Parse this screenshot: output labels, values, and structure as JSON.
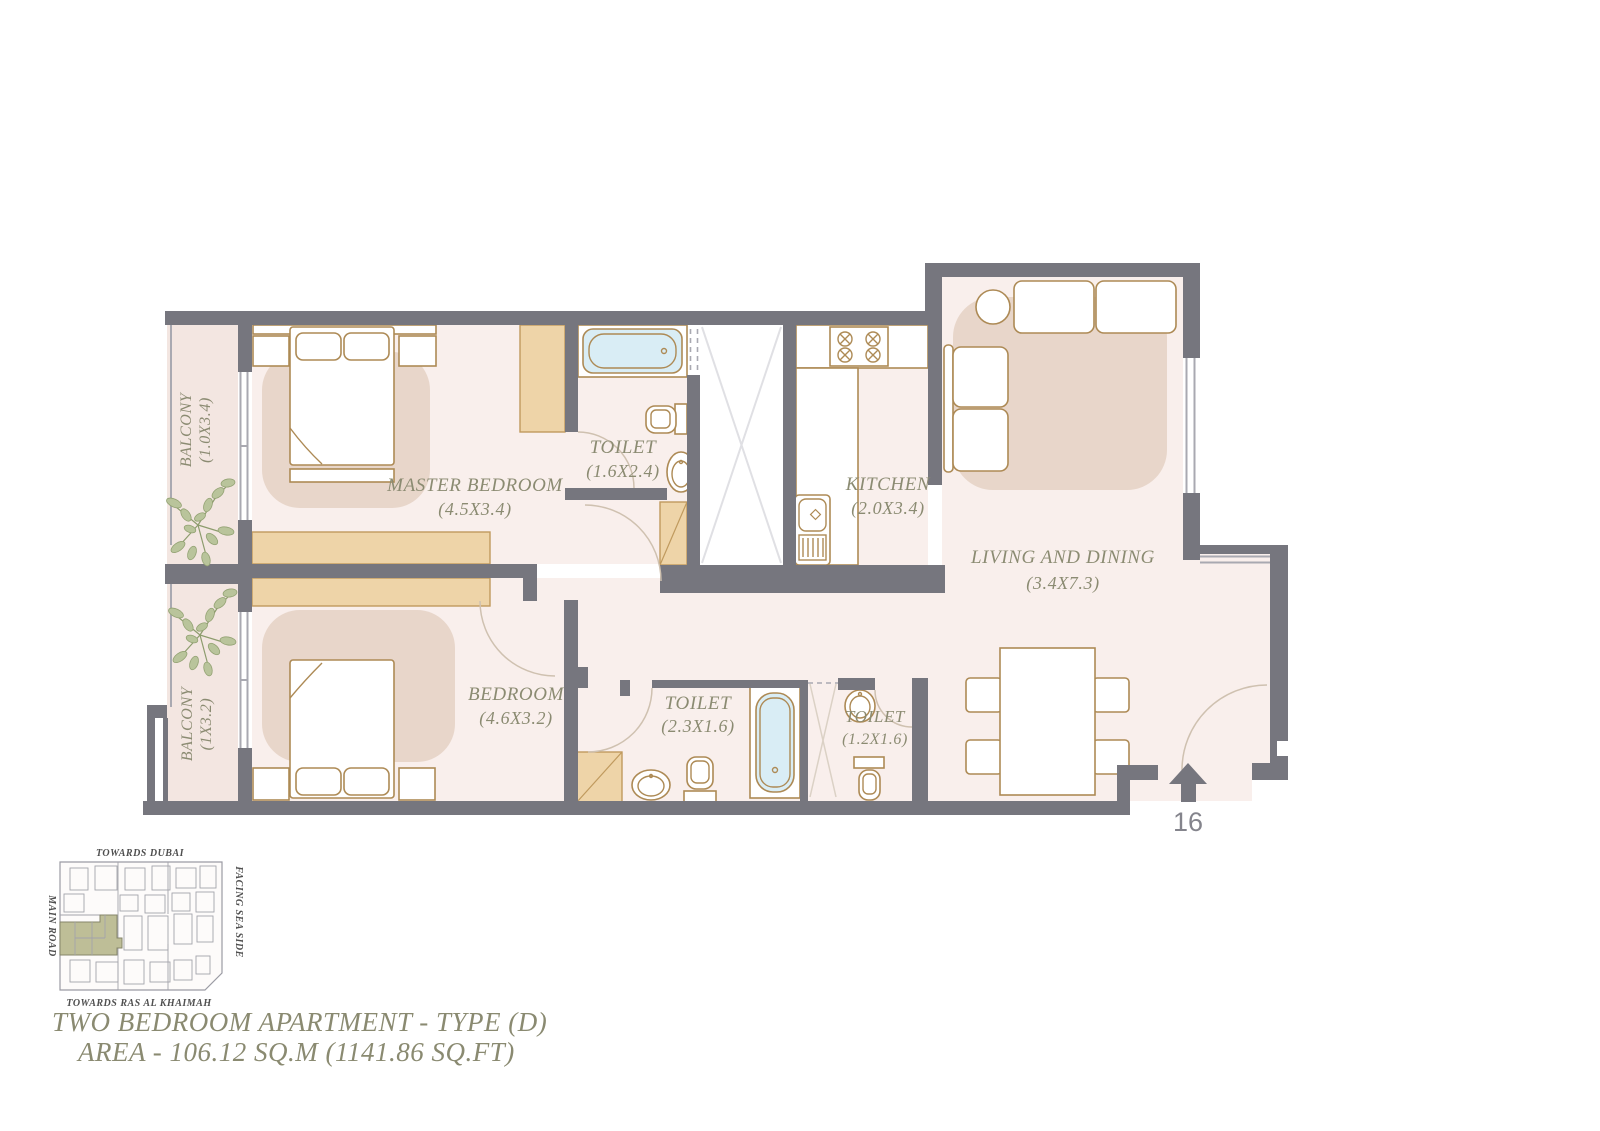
{
  "title": {
    "line1": "TWO BEDROOM APARTMENT - TYPE (D)",
    "line2": "AREA - 106.12 SQ.M (1141.86 SQ.FT)"
  },
  "unit_number": "16",
  "rooms": {
    "master_bedroom": {
      "name": "MASTER BEDROOM",
      "dims": "(4.5X3.4)"
    },
    "bedroom": {
      "name": "BEDROOM",
      "dims": "(4.6X3.2)"
    },
    "toilet_master": {
      "name": "TOILET",
      "dims": "(1.6X2.4)"
    },
    "toilet_shared": {
      "name": "TOILET",
      "dims": "(2.3X1.6)"
    },
    "toilet_guest": {
      "name": "TOILET",
      "dims": "(1.2X1.6)"
    },
    "kitchen": {
      "name": "KITCHEN",
      "dims": "(2.0X3.4)"
    },
    "living_dining": {
      "name": "LIVING AND DINING",
      "dims": "(3.4X7.3)"
    },
    "balcony_master": {
      "name": "BALCONY",
      "dims": "(1.0X3.4)"
    },
    "balcony_bedroom": {
      "name": "BALCONY",
      "dims": "(1X3.2)"
    }
  },
  "location_map": {
    "top": "TOWARDS DUBAI",
    "left": "MAIN ROAD",
    "right": "FACING SEA SIDE",
    "bottom": "TOWARDS RAS AL KHAIMAH"
  },
  "colors": {
    "wall": "#76767e",
    "room_fill": "#f9efec",
    "balcony_fill": "#f3e6e1",
    "rug": "#e8d6ca",
    "cabinet": "#eed4a8",
    "furniture_stroke": "#ad8a55",
    "bathtub": "#d9edf5",
    "label_text": "#8b8b72",
    "plant": "#9aa87c",
    "map_highlight": "#bebe97"
  }
}
